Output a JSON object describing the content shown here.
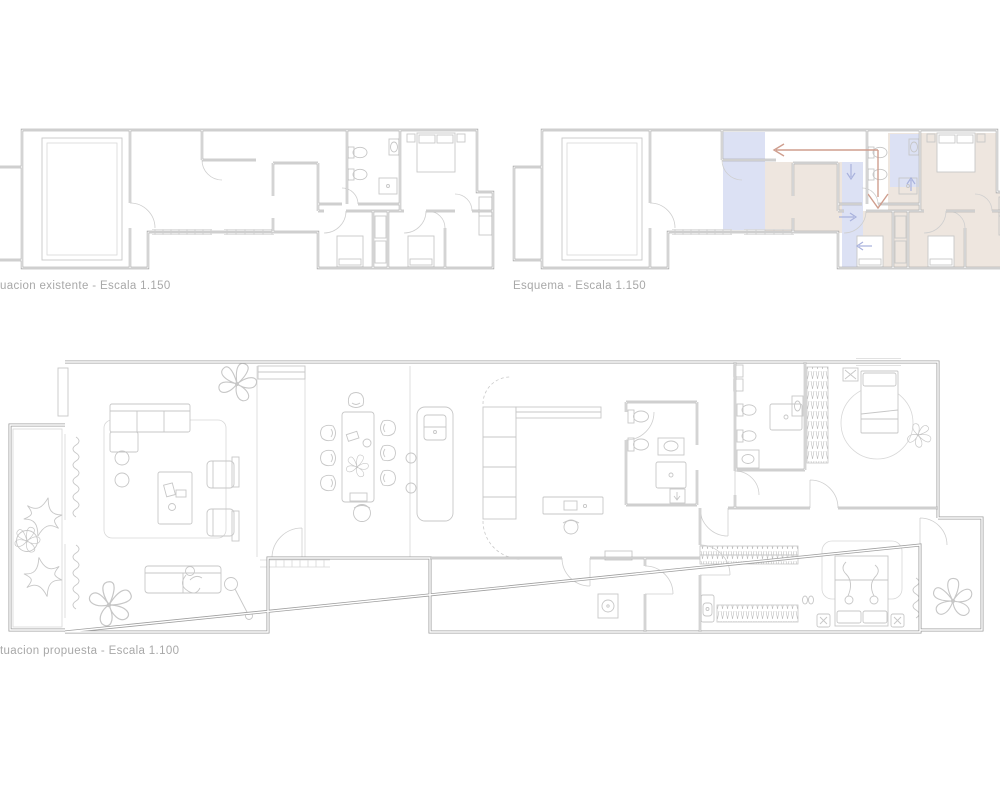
{
  "sheet": {
    "title": "apartment reform drawing sheet"
  },
  "captions": {
    "existing": "uacion existente - Escala 1.150",
    "esquema": "Esquema - Escala 1.150",
    "proposed": "tuacion propuesta - Escala 1.100"
  },
  "plans": [
    {
      "id": "existing",
      "scale": "1.150"
    },
    {
      "id": "esquema",
      "scale": "1.150"
    },
    {
      "id": "proposed",
      "scale": "1.100"
    }
  ],
  "colors": {
    "bg": "#ffffff",
    "wall": "#9f9f9f",
    "furn": "#c7c7c7",
    "lite": "#d8d8d8",
    "zblue": "#dce1f4",
    "ztan": "#eee6df",
    "salmon": "#cf9e8e",
    "ablue": "#a9b2dd",
    "caption": "#a8a8a8"
  },
  "icons": {
    "bed": "double-bed-icon",
    "single_bed": "single-bed-icon",
    "sofa": "sofa-icon",
    "dining_table": "dining-table-icon",
    "kitchen_island": "kitchen-island-icon",
    "toilet": "toilet-icon",
    "washbasin": "washbasin-icon",
    "shower": "shower-icon",
    "wardrobe": "hatched-wardrobe-icon",
    "plant": "plant-scribble-icon",
    "pouf": "star-pouf-icon",
    "floor_lamp": "floor-lamp-icon",
    "door": "door-swing-arc"
  }
}
